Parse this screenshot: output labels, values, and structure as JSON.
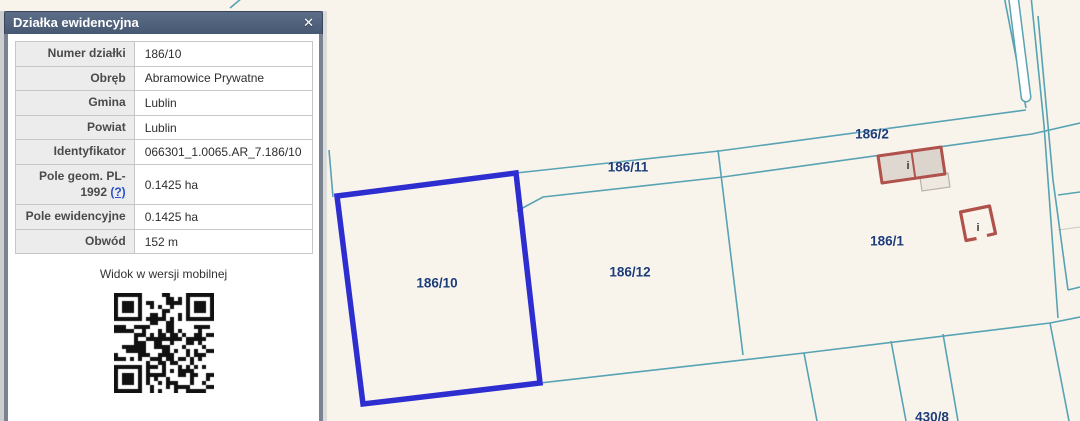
{
  "window": {
    "title": "Działka ewidencyjna",
    "close_icon": "✕"
  },
  "panel": {
    "rows": [
      {
        "label": "Numer działki",
        "value": "186/10"
      },
      {
        "label": "Obręb",
        "value": "Abramowice Prywatne"
      },
      {
        "label": "Gmina",
        "value": "Lublin"
      },
      {
        "label": "Powiat",
        "value": "Lublin"
      },
      {
        "label": "Identyfikator",
        "value": "066301_1.0065.AR_7.186/10"
      },
      {
        "label": "Pole geom. PL-1992",
        "help": "(?)",
        "value": "0.1425 ha"
      },
      {
        "label": "Pole ewidencyjne",
        "value": "0.1425 ha"
      },
      {
        "label": "Obwód",
        "value": "152 m"
      }
    ],
    "mobile_caption": "Widok w wersji mobilnej"
  },
  "map": {
    "selected_parcel": "186/10",
    "building_info_glyph": "i",
    "labels": [
      {
        "text": "186/11",
        "x": 628,
        "y": 167
      },
      {
        "text": "186/2",
        "x": 872,
        "y": 134
      },
      {
        "text": "186/12",
        "x": 630,
        "y": 272
      },
      {
        "text": "186/1",
        "x": 887,
        "y": 241
      },
      {
        "text": "186/10",
        "x": 437,
        "y": 283
      },
      {
        "text": "430/8",
        "x": 932,
        "y": 417
      }
    ]
  },
  "colors": {
    "map_bg": "#f8f4ec",
    "boundary_line": "#57a3b3",
    "selection_blue": "#2d2dd0",
    "parcel_label_navy": "#1e3c78",
    "building_stroke": "#b0524b",
    "building_fill": "#d9d2cb",
    "header_bg": "#4e5f7a",
    "frame_gray": "#7b8391",
    "link_blue": "#2b50c8"
  }
}
